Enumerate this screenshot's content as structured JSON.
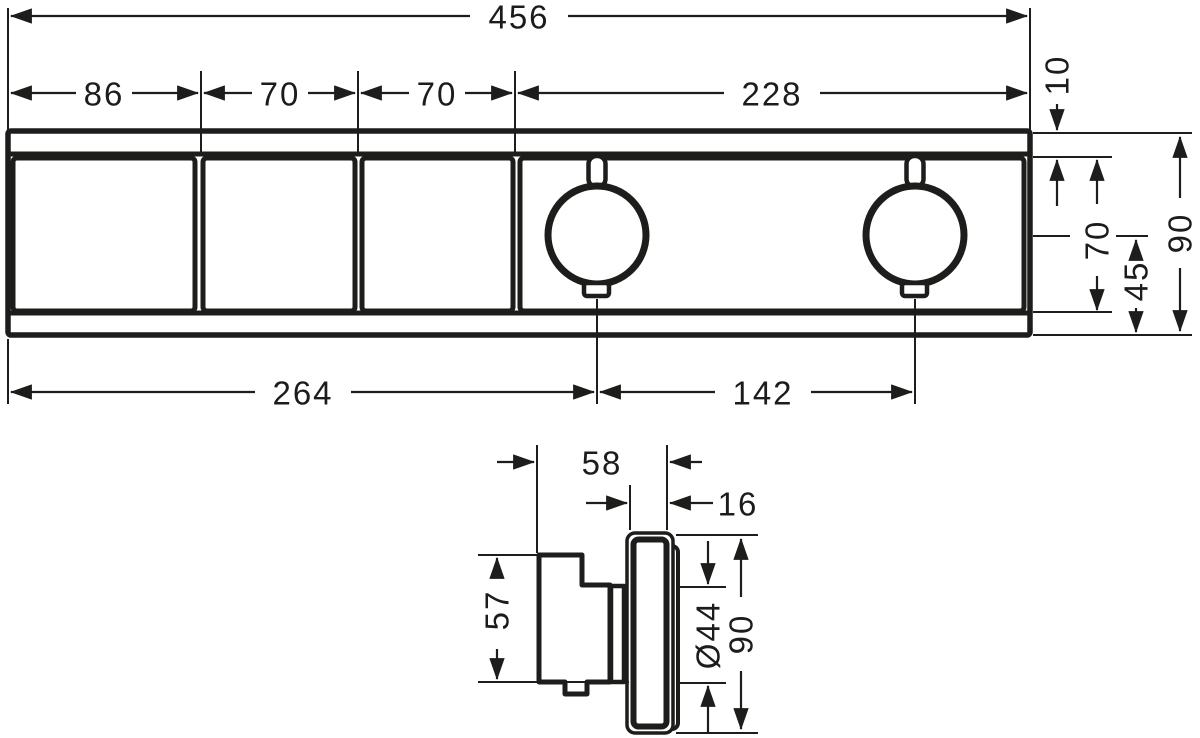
{
  "front_view": {
    "overall_width": "456",
    "segment_widths": [
      "86",
      "70",
      "70",
      "228"
    ],
    "top_edge_to_plate": "10",
    "plate_inner_height": "70",
    "handle_center_to_bottom": "45",
    "overall_height": "90",
    "left_edge_to_handle1_center": "264",
    "handle1_to_handle2_center": "142"
  },
  "side_view": {
    "front_to_wall_depth": "58",
    "plate_thickness": "16",
    "handle_height": "57",
    "handle_diameter": "Ø44",
    "plate_height": "90"
  },
  "style": {
    "line_color": "#1d1d1b",
    "background": "#ffffff"
  }
}
